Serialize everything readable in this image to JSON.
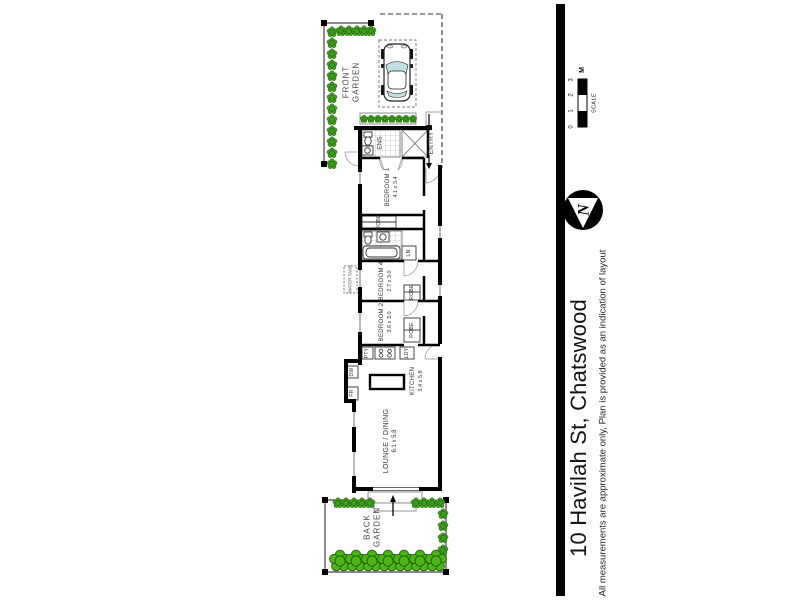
{
  "page": {
    "background": "#ffffff"
  },
  "side_panel": {
    "address": "10 Havilah St, Chatswood",
    "disclaimer": "All measurements are approximate only, Plan is provided as an indication of layout",
    "divider_color": "#000000",
    "scale_bar": {
      "label": "SCALE",
      "unit": "M",
      "ticks": [
        "0",
        "1",
        "2",
        "3"
      ]
    },
    "compass": {
      "letter": "N"
    }
  },
  "plan": {
    "front_garden_label": "FRONT\nGARDEN",
    "back_garden_label": "BACK\nGARDEN",
    "entry_label": "ENTRY",
    "water_tank_label": "WATER TANK",
    "rooms": {
      "ens": {
        "name": "ENS"
      },
      "bedroom1": {
        "name": "BEDROOM 1",
        "dims": "4.1 x 3.4"
      },
      "robe1": {
        "name": "ROBE"
      },
      "linen": {
        "name": "LN"
      },
      "bedroom4": {
        "name": "BEDROOM 4",
        "dims": "2.7 x 3.0"
      },
      "robe4": {
        "name": "ROBE"
      },
      "bedroom2": {
        "name": "BEDROOM 2",
        "dims": "3.6 x 3.0"
      },
      "robe2": {
        "name": "ROBE"
      },
      "pantry": {
        "name": "PTY"
      },
      "laundry": {
        "name": "LDY"
      },
      "kitchen": {
        "name": "KITCHEN",
        "dims": "3.4 x 5.8"
      },
      "fridge": {
        "name": "FR"
      },
      "dishwasher": {
        "name": "DW"
      },
      "lounge": {
        "name": "LOUNGE / DINING",
        "dims": "6.1 x 5.8"
      }
    }
  },
  "colors": {
    "tree_green": "#3da01c",
    "bush_green": "#4cb515",
    "car_glass": "#bfe0e4",
    "wall_black": "#000000"
  }
}
